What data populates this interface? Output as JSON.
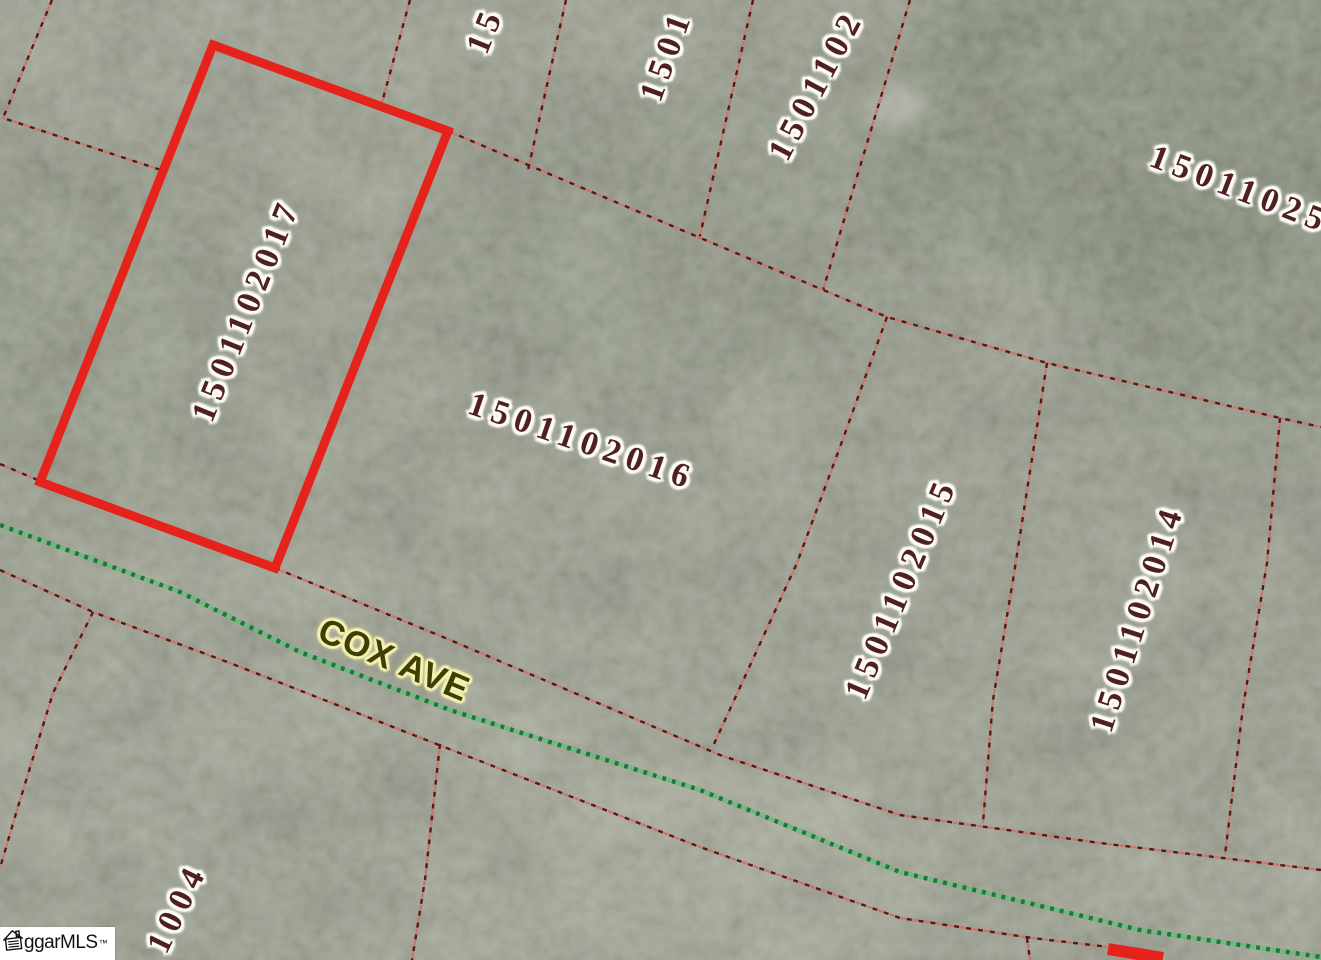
{
  "canvas": {
    "width": 1321,
    "height": 960
  },
  "colors": {
    "base": "#a2a796",
    "parcel_line_dark": "#5d1616",
    "parcel_line_light": "#cf7468",
    "highlight": "#e5231b",
    "road_green_dark": "#177c3a",
    "road_green_light": "#67bd7c",
    "label_text": "#4e1f26",
    "label_halo": "#fdfdf6",
    "street_text": "#3e3e08",
    "street_halo": "#f6f2ae"
  },
  "highlight_parcel": {
    "label": "1501102017",
    "points": [
      [
        213,
        45
      ],
      [
        448,
        131
      ],
      [
        275,
        568
      ],
      [
        40,
        482
      ]
    ]
  },
  "boundaries": [
    {
      "points": [
        [
          52,
          0
        ],
        [
          3,
          118
        ],
        [
          161,
          170
        ]
      ]
    },
    {
      "points": [
        [
          410,
          0
        ],
        [
          381,
          106
        ]
      ]
    },
    {
      "points": [
        [
          566,
          0
        ],
        [
          528,
          170
        ]
      ]
    },
    {
      "points": [
        [
          753,
          0
        ],
        [
          699,
          240
        ]
      ]
    },
    {
      "points": [
        [
          910,
          0
        ],
        [
          823,
          290
        ]
      ]
    },
    {
      "points": [
        [
          448,
          131
        ],
        [
          887,
          317
        ],
        [
          1047,
          363
        ],
        [
          1280,
          418
        ],
        [
          1321,
          427
        ]
      ]
    },
    {
      "points": [
        [
          887,
          317
        ],
        [
          840,
          447
        ],
        [
          797,
          563
        ],
        [
          714,
          744
        ]
      ]
    },
    {
      "points": [
        [
          1047,
          363
        ],
        [
          1013,
          580
        ],
        [
          993,
          700
        ],
        [
          983,
          823
        ]
      ]
    },
    {
      "points": [
        [
          1280,
          418
        ],
        [
          1267,
          563
        ],
        [
          1243,
          707
        ],
        [
          1225,
          855
        ]
      ]
    },
    {
      "points": [
        [
          0,
          464
        ],
        [
          40,
          481
        ]
      ]
    },
    {
      "points": [
        [
          275,
          568
        ],
        [
          443,
          637
        ],
        [
          720,
          755
        ],
        [
          900,
          815
        ],
        [
          1100,
          843
        ],
        [
          1321,
          870
        ]
      ]
    },
    {
      "points": [
        [
          0,
          570
        ],
        [
          93,
          612
        ],
        [
          230,
          663
        ],
        [
          393,
          727
        ],
        [
          700,
          847
        ],
        [
          900,
          918
        ],
        [
          1032,
          938
        ],
        [
          1160,
          953
        ]
      ]
    },
    {
      "points": [
        [
          93,
          612
        ],
        [
          53,
          693
        ],
        [
          17,
          810
        ],
        [
          0,
          868
        ]
      ]
    },
    {
      "points": [
        [
          440,
          744
        ],
        [
          425,
          880
        ],
        [
          412,
          960
        ]
      ]
    },
    {
      "points": [
        [
          1027,
          938
        ],
        [
          1030,
          960
        ]
      ]
    }
  ],
  "road": {
    "name": "COX AVE",
    "centerline": [
      [
        0,
        525
      ],
      [
        180,
        592
      ],
      [
        300,
        652
      ],
      [
        450,
        710
      ],
      [
        700,
        790
      ],
      [
        900,
        872
      ],
      [
        1140,
        930
      ],
      [
        1321,
        957
      ]
    ]
  },
  "red_mark": [
    [
      1108,
      949
    ],
    [
      1163,
      958
    ]
  ],
  "labels": [
    {
      "text": "15",
      "x": 486,
      "y": 30,
      "rot": -68,
      "kind": "parcel"
    },
    {
      "text": "1501",
      "x": 667,
      "y": 55,
      "rot": -70,
      "kind": "parcel"
    },
    {
      "text": "1501102",
      "x": 817,
      "y": 85,
      "rot": -62,
      "kind": "parcel"
    },
    {
      "text": "15011025",
      "x": 1240,
      "y": 190,
      "rot": 21,
      "kind": "parcel"
    },
    {
      "text": "1501102017",
      "x": 247,
      "y": 310,
      "rot": -68,
      "kind": "parcel"
    },
    {
      "text": "1501102016",
      "x": 582,
      "y": 442,
      "rot": 19,
      "kind": "parcel"
    },
    {
      "text": "1501102015",
      "x": 902,
      "y": 588,
      "rot": -67,
      "kind": "parcel"
    },
    {
      "text": "1501102014",
      "x": 1138,
      "y": 618,
      "rot": -72,
      "kind": "parcel"
    },
    {
      "text": "1004",
      "x": 178,
      "y": 908,
      "rot": -64,
      "kind": "parcel"
    },
    {
      "text": "COX AVE",
      "x": 394,
      "y": 660,
      "rot": 23,
      "kind": "street"
    }
  ],
  "watermark": {
    "text": "ggarMLS",
    "tm": "™",
    "icon": "house-icon"
  }
}
